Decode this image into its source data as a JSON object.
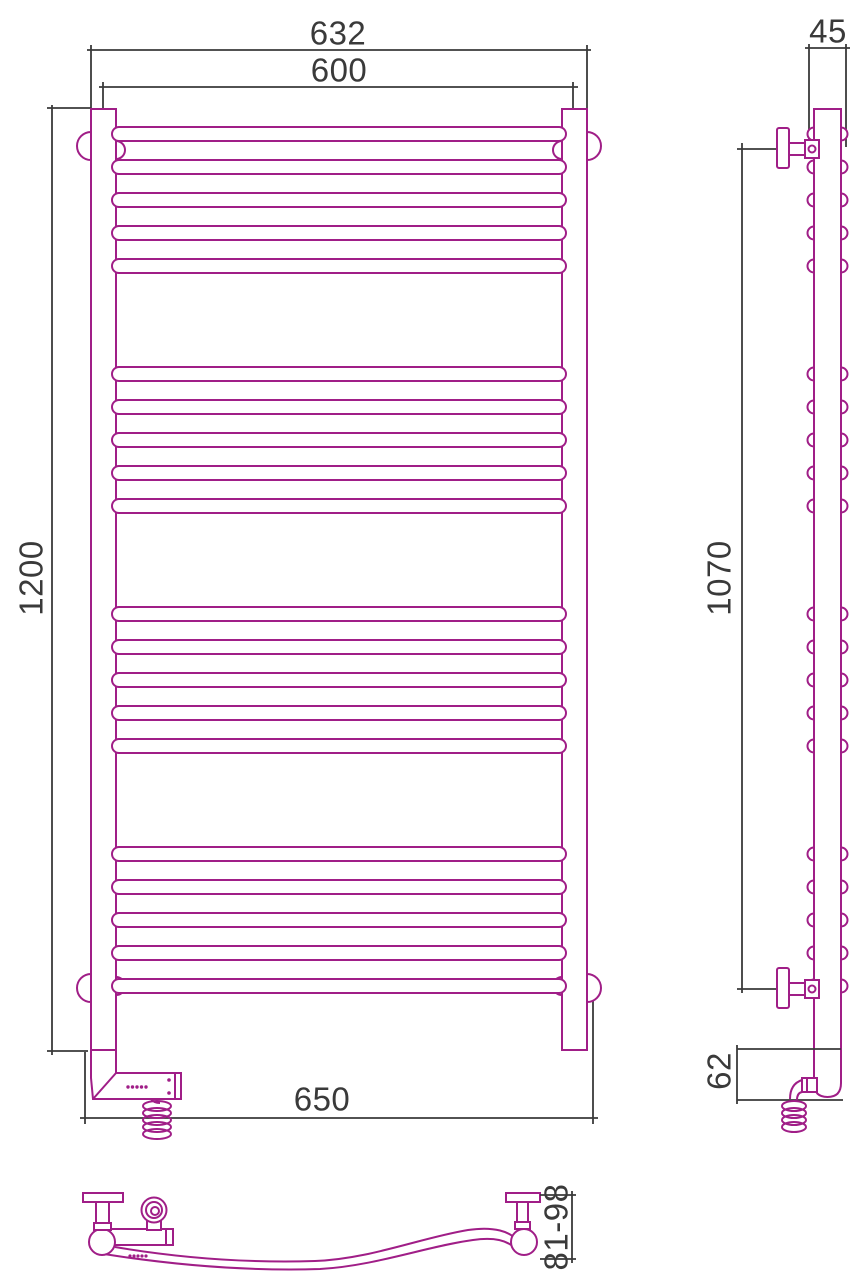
{
  "colors": {
    "product": "#a01e87",
    "dimension": "#3a3a3a",
    "background": "#ffffff"
  },
  "front_view": {
    "dimensions": {
      "overall_width": "632",
      "center_width": "600",
      "overall_height": "1200",
      "bottom_width": "650"
    }
  },
  "side_view": {
    "dimensions": {
      "depth": "45",
      "bracket_span": "1070",
      "bottom_offset": "62"
    }
  },
  "bottom_view": {
    "dimensions": {
      "wall_distance": "81-98"
    }
  },
  "structure": {
    "rung_groups": 4,
    "rungs_per_group": 5,
    "total_rungs": 20
  }
}
